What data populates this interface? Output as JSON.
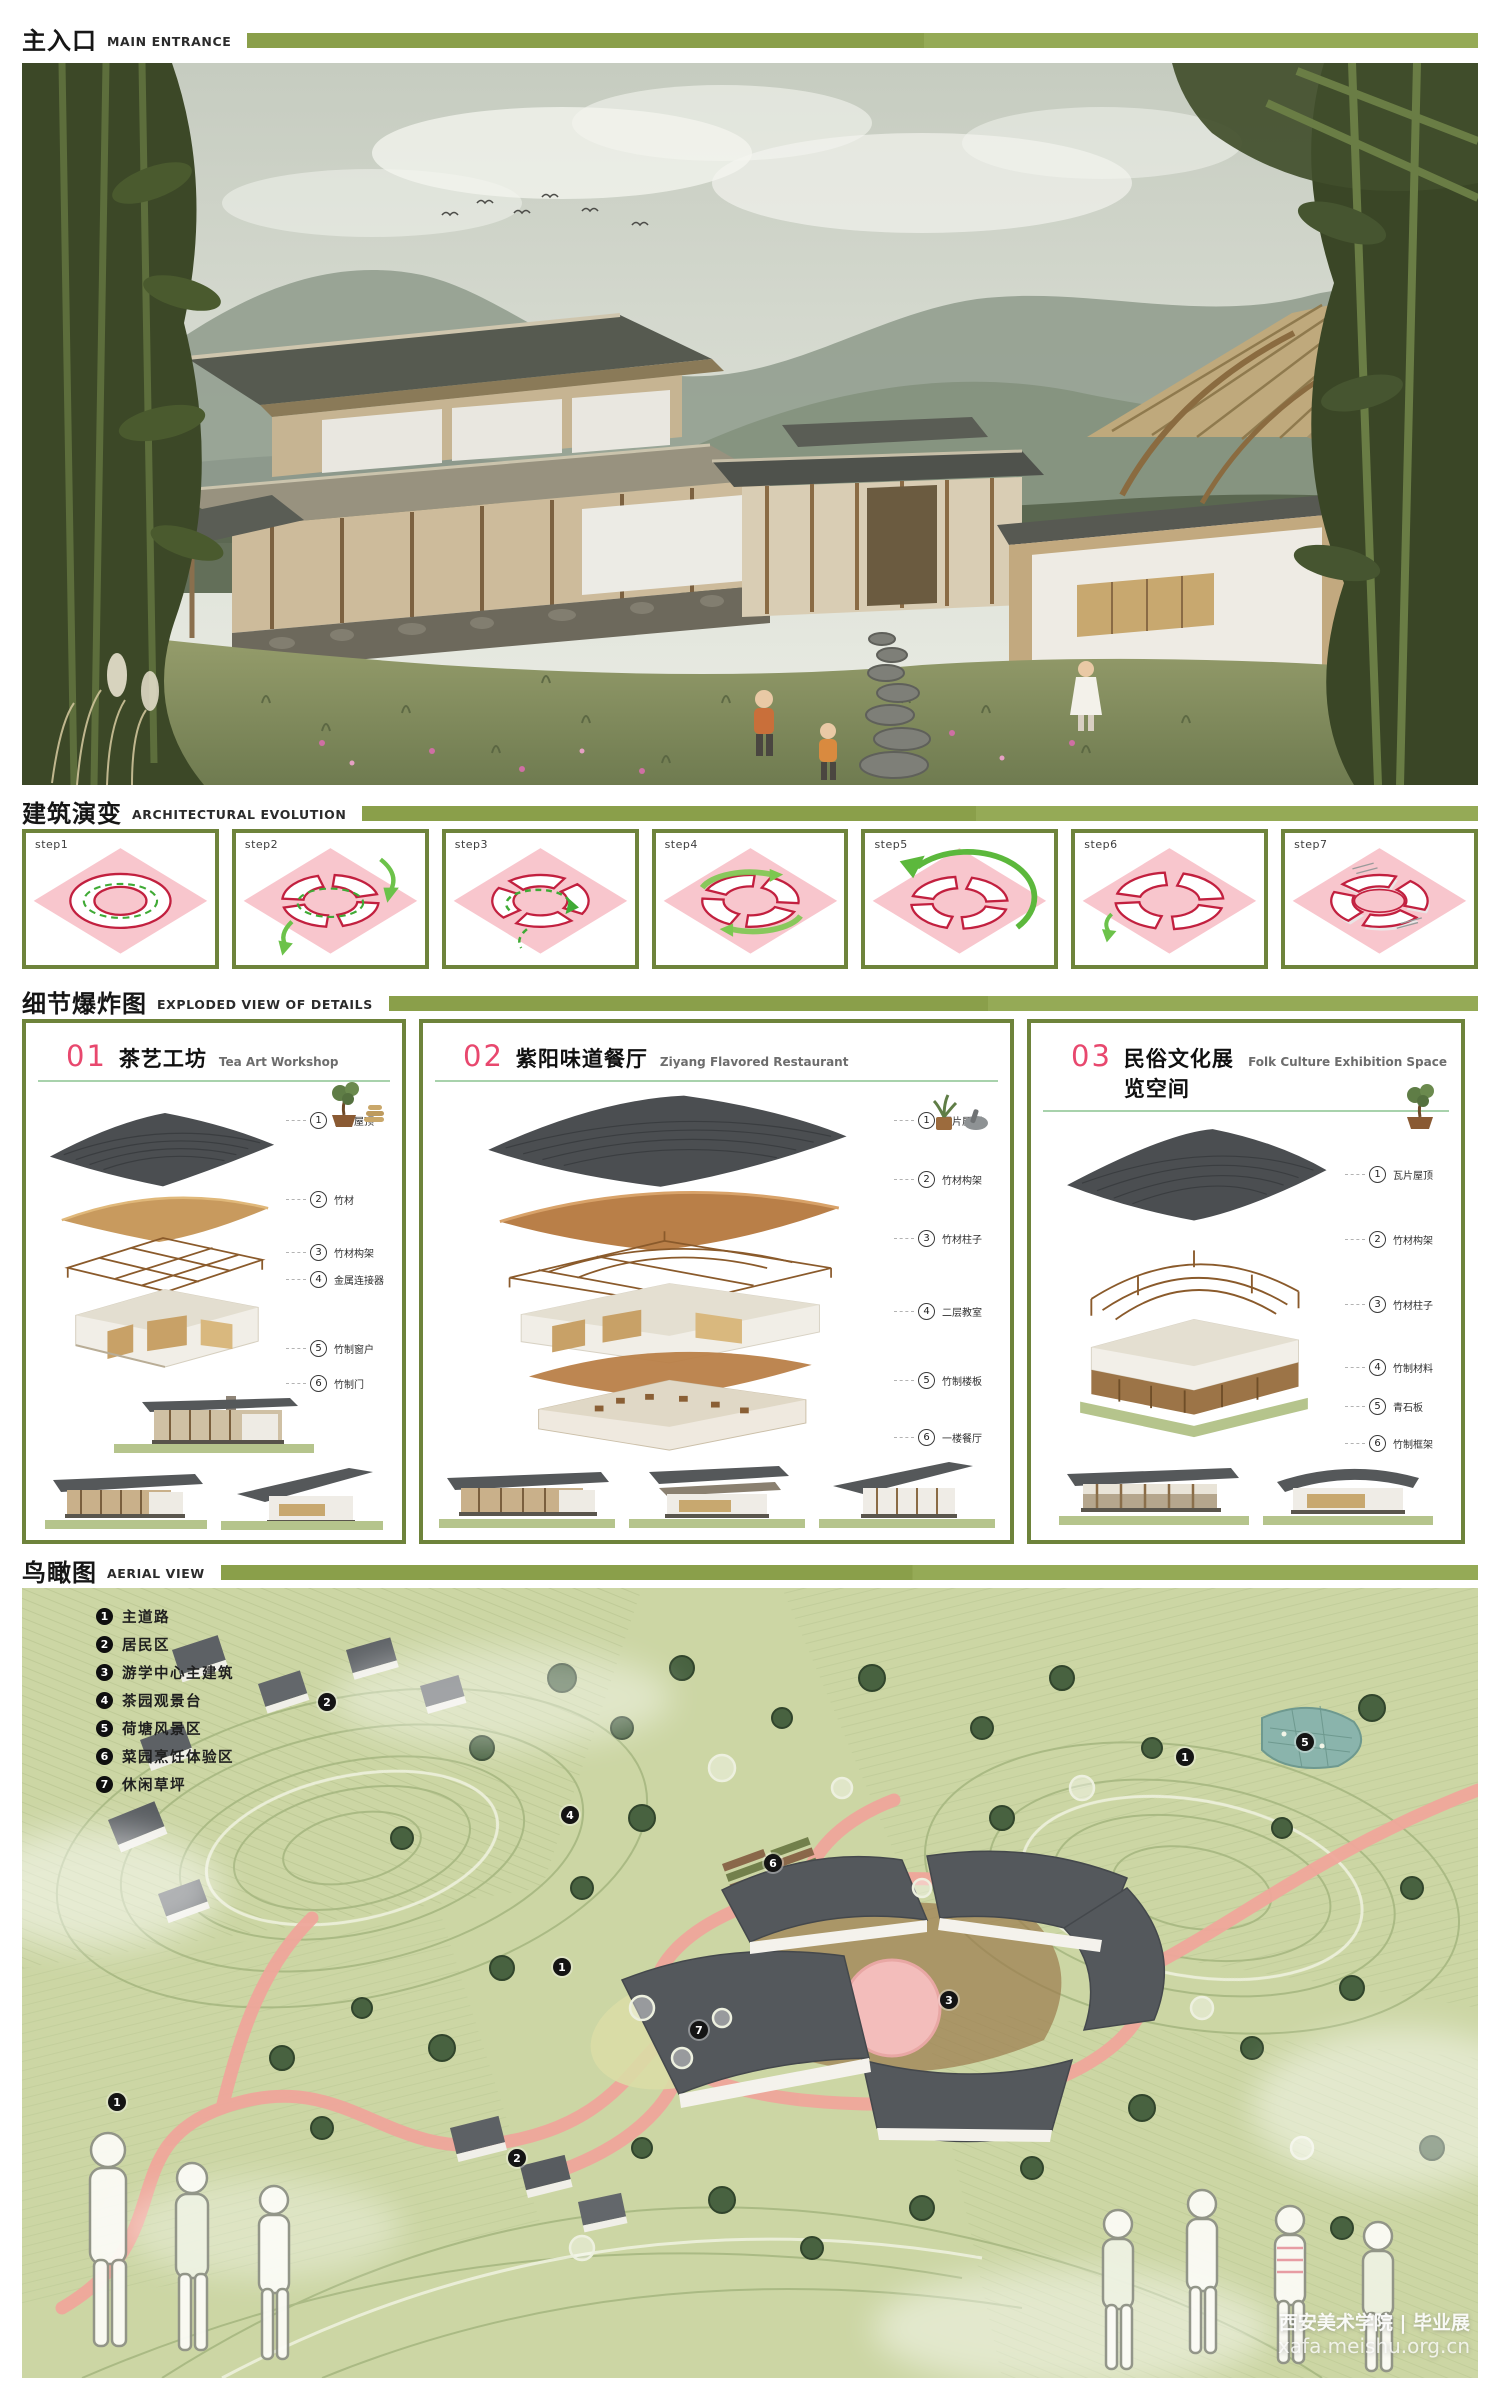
{
  "board": {
    "accent_green": "#8a9f4a",
    "accent_pink": "#e8486e",
    "diagram_outline_red": "#c2203f",
    "diagram_arrow_green": "#55b23d"
  },
  "sections": {
    "main_entrance": {
      "title_zh": "主入口",
      "title_en": "MAIN ENTRANCE"
    },
    "evolution": {
      "title_zh": "建筑演变",
      "title_en": "ARCHITECTURAL EVOLUTION",
      "steps": [
        {
          "label": "step1"
        },
        {
          "label": "step2"
        },
        {
          "label": "step3"
        },
        {
          "label": "step4"
        },
        {
          "label": "step5"
        },
        {
          "label": "step6"
        },
        {
          "label": "step7"
        }
      ]
    },
    "exploded": {
      "title_zh": "细节爆炸图",
      "title_en": "EXPLODED VIEW OF DETAILS",
      "panels": [
        {
          "number": "01",
          "title_zh": "茶艺工坊",
          "title_en": "Tea Art Workshop",
          "callouts": [
            {
              "num": "1",
              "label": "瓦片屋顶"
            },
            {
              "num": "2",
              "label": "竹材"
            },
            {
              "num": "3",
              "label": "竹材构架"
            },
            {
              "num": "4",
              "label": "金属连接器"
            },
            {
              "num": "5",
              "label": "竹制窗户"
            },
            {
              "num": "6",
              "label": "竹制门"
            }
          ]
        },
        {
          "number": "02",
          "title_zh": "紫阳味道餐厅",
          "title_en": "Ziyang Flavored Restaurant",
          "callouts": [
            {
              "num": "1",
              "label": "瓦片屋顶"
            },
            {
              "num": "2",
              "label": "竹材构架"
            },
            {
              "num": "3",
              "label": "竹材柱子"
            },
            {
              "num": "4",
              "label": "二层教室"
            },
            {
              "num": "5",
              "label": "竹制楼板"
            },
            {
              "num": "6",
              "label": "一楼餐厅"
            }
          ]
        },
        {
          "number": "03",
          "title_zh": "民俗文化展览空间",
          "title_en": "Folk Culture Exhibition Space",
          "callouts": [
            {
              "num": "1",
              "label": "瓦片屋顶"
            },
            {
              "num": "2",
              "label": "竹材构架"
            },
            {
              "num": "3",
              "label": "竹材柱子"
            },
            {
              "num": "4",
              "label": "竹制材料"
            },
            {
              "num": "5",
              "label": "青石板"
            },
            {
              "num": "6",
              "label": "竹制框架"
            }
          ]
        }
      ]
    },
    "aerial": {
      "title_zh": "鸟瞰图",
      "title_en": "AERIAL VIEW",
      "legend": [
        {
          "num": "1",
          "label": "主道路"
        },
        {
          "num": "2",
          "label": "居民区"
        },
        {
          "num": "3",
          "label": "游学中心主建筑"
        },
        {
          "num": "4",
          "label": "茶园观景台"
        },
        {
          "num": "5",
          "label": "荷塘风景区"
        },
        {
          "num": "6",
          "label": "菜园烹饪体验区"
        },
        {
          "num": "7",
          "label": "休闲草坪"
        }
      ],
      "markers": [
        {
          "num": "2"
        },
        {
          "num": "5"
        },
        {
          "num": "1"
        },
        {
          "num": "4"
        },
        {
          "num": "6"
        },
        {
          "num": "1"
        },
        {
          "num": "3"
        },
        {
          "num": "7"
        },
        {
          "num": "1"
        },
        {
          "num": "2"
        }
      ]
    }
  },
  "watermark": {
    "line1": "西安美术学院 | 毕业展",
    "line2": "xafa.meishu.org.cn"
  }
}
